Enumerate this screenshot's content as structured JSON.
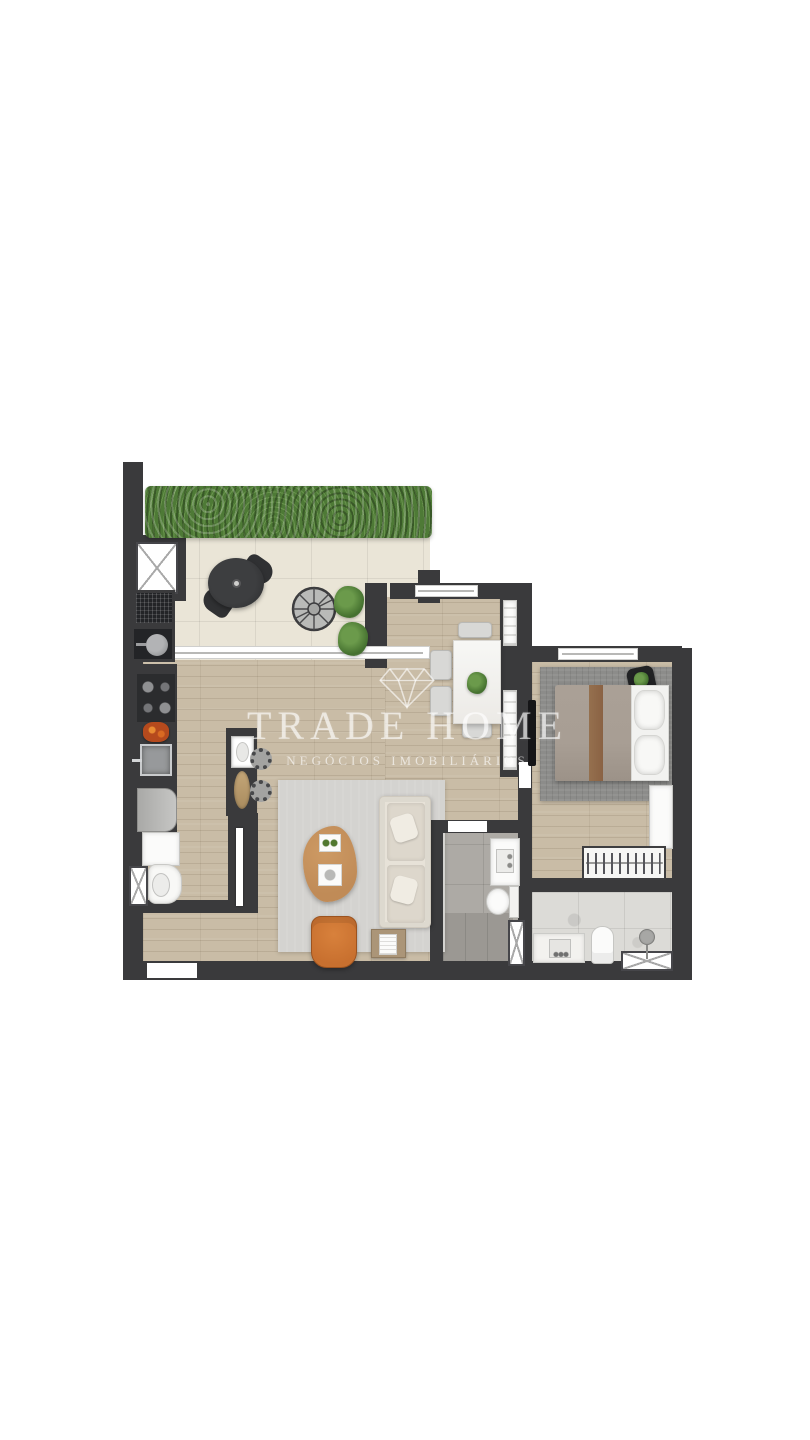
{
  "watermark": {
    "logo_icon": "diamond-outline-icon",
    "brand": "TRADE HOME",
    "tagline": "NEGÓCIOS IMOBILIÁRIOS"
  },
  "palette": {
    "background": "#ffffff",
    "wall": "#3a3a3c",
    "wood_floor": "#c9bca6",
    "terrace_tile": "#eae5d7",
    "hedge_green": "#4e7a36",
    "living_rug": "#d4d3d0",
    "bedroom_rug": "#8c8c8a",
    "sofa_cream": "#e7e2d8",
    "armchair_orange": "#c8702f",
    "coffee_table_wood": "#c08b57",
    "bed_duvet": "#a89e94",
    "bed_runner": "#8a6244",
    "bath_tile_gray": "#adaaa5",
    "bath_marble": "#dcdbd7"
  },
  "plan": {
    "type": "apartment-floor-plan-top-view",
    "rooms": [
      "terrace",
      "kitchen",
      "living-room",
      "dining-room",
      "bedroom",
      "bathroom",
      "suite-bathroom",
      "laundry-wc"
    ]
  }
}
